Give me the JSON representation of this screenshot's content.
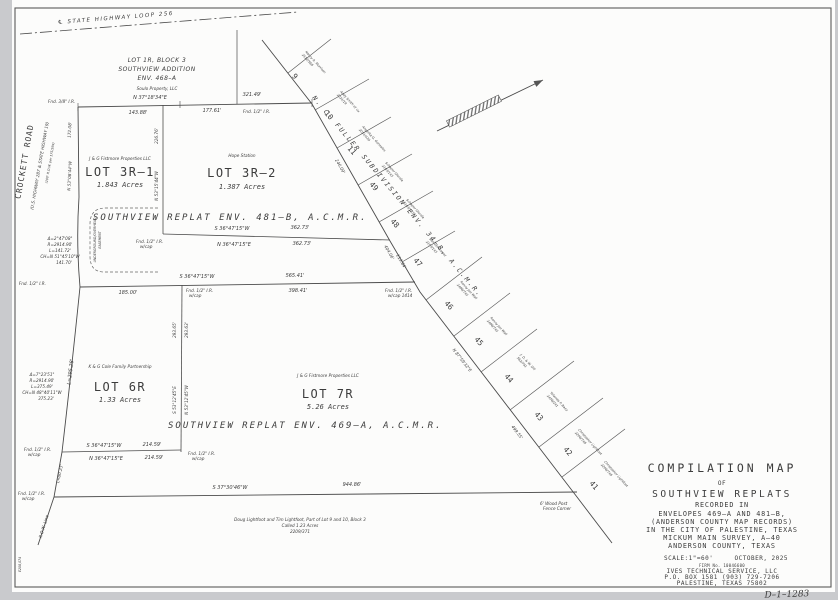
{
  "page": {
    "sheet_no": "D–1–1283",
    "margin_code": "E208,074"
  },
  "highway": {
    "label": "℄  STATE  HIGHWAY  LOOP  256"
  },
  "crockett": {
    "name": "CROCKETT  ROAD",
    "hw": "(U.S. HIGHWAY 287 & STATE HIGHWAY 19)",
    "row": "(100' R.O.W. per 175/594)"
  },
  "lot1r": {
    "line1": "LOT 1R, BLOCK 3",
    "line2": "SOUTHVIEW ADDITION",
    "line3": "ENV. 468–A",
    "owner": "Soulo Property, LLC"
  },
  "lot3r1": {
    "owner": "J & G Fistmore Properties LLC",
    "name": "LOT 3R–1",
    "acres": "1.843 Acres"
  },
  "lot3r2": {
    "owner": "Hope Station",
    "name": "LOT 3R–2",
    "acres": "1.387 Acres"
  },
  "lot6r": {
    "owner": "K & G Cole Family Partnership",
    "name": "LOT 6R",
    "acres": "1.33 Acres"
  },
  "lot7r": {
    "owner": "J & G Fistmore Properties LLC",
    "name": "LOT 7R",
    "acres": "5.26 Acres"
  },
  "replat": {
    "env481": "SOUTHVIEW  REPLAT   ENV.  481–B,  A.C.M.R.",
    "env469": "SOUTHVIEW  REPLAT   ENV.  469–A,  A.C.M.R."
  },
  "fuller": {
    "title": "N. C.  FULLER  SUBDIVISION     ENV.  34–B,  A.C.M.R.",
    "lots": [
      {
        "num": "9",
        "owner": "Nancy A. Morrison",
        "deed": "2512/568"
      },
      {
        "num": "10",
        "owner": "Andy Smith et ux",
        "deed": "2021/19"
      },
      {
        "num": "11",
        "owner": "Angelita G. Gonzales",
        "deed": "2051/439"
      },
      {
        "num": "49",
        "owner": "Schaper Glenda",
        "deed": "2103/143"
      },
      {
        "num": "48",
        "owner": "Schaper Glenda",
        "deed": "2103/143"
      },
      {
        "num": "47",
        "owner": "Samuel Gomez",
        "deed": "2103/143"
      },
      {
        "num": "46",
        "owner": "Ronny Joe Wall",
        "deed": "2486/742"
      },
      {
        "num": "45",
        "owner": "Ronny Joe Wall",
        "deed": "2486/742"
      },
      {
        "num": "44",
        "owner": "J. D. & W. Dill",
        "deed": "562/791"
      },
      {
        "num": "43",
        "owner": "Yolanda P. Baez",
        "deed": "2456/241"
      },
      {
        "num": "42",
        "owner": "Christopher Lightfoot",
        "deed": "2206/748"
      },
      {
        "num": "41",
        "owner": "Christopher Lightfoot",
        "deed": "2206/748"
      }
    ]
  },
  "dims": {
    "top_bearing": "N 37°18'34\"E",
    "top_total": "321.49'",
    "top_d1": "143.88'",
    "top_d2": "177.61'",
    "west_dist": "172.08'",
    "west_bearing": "N 53°08'44\"W",
    "div1_dist": "226.76'",
    "div1_bearing": "N 53°15'44\"W",
    "l362_s": "S 36°47'15\"W",
    "l362_n": "N 36°47'15\"E",
    "d362": "362.73'",
    "mid_bearing": "S 36°47'15\"W",
    "mid_d1": "185.00'",
    "mid_total": "565.41'",
    "mid_sub": "398.41'",
    "div2_dl": "293.65'",
    "div2_dr": "293.63'",
    "div2_s": "S 53°12'45\"E",
    "div2_n": "N 53°12'45\"W",
    "b6r_s": "S 36°47'15\"W",
    "b6r_n": "N 36°47'15\"E",
    "b6r_d": "214.59'",
    "bottom_bearing": "S 37°30'46\"W",
    "bottom_dist": "944.86'",
    "arc1": "L=295.28'",
    "arc2": "L=80.23'",
    "row_line": "R.O.W. Line",
    "diag_246": "246.09'",
    "diag_404": "404.06'",
    "diag_113": "113.84'",
    "diag_bearing": "N 87°59'32\"E",
    "diag_499": "499.55'"
  },
  "curve1": {
    "d": "Δ=2°47'08\"",
    "r": "R=2914.90'",
    "l": "L=141.72'",
    "ch": "CH=N 51°45'10\"W",
    "chd": "141.70'"
  },
  "curve2": {
    "d": "Δ=7°23'51\"",
    "r": "R=2914.90'",
    "l": "L=375.49'",
    "ch": "CH=N 48°40'11\"W",
    "chd": "375.23'"
  },
  "monuments": {
    "fnd38": "Fnd. 3/8\" I.R.",
    "fnd12": "Fnd. 1/2\" I.R.",
    "wcap": "w/cap",
    "wcap1414": "w/cap 1414",
    "fence1": "6' Wood Post",
    "fence2": "Fence Corner"
  },
  "easement": {
    "line1": "UNDERGROUND/OVERHEAD",
    "line2": "EASEMENT"
  },
  "note": {
    "line1": "Doug Lightfoot and Tim Lightfoot,  Part of Lot 9 and 10, Block 3",
    "line2": "Called 1.23 Acres",
    "line3": "2209/371"
  },
  "title_block": {
    "l1": "COMPILATION  MAP",
    "l2": "OF",
    "l3": "SOUTHVIEW  REPLATS",
    "l4": "RECORDED  IN",
    "l5": "ENVELOPES  469–A  AND  481–B,",
    "l6": "(ANDERSON  COUNTY  MAP  RECORDS)",
    "l7": "IN  THE  CITY  OF  PALESTINE,  TEXAS",
    "l8": "MICKUM  MAIN  SURVEY,  A–40",
    "l9": "ANDERSON  COUNTY,  TEXAS",
    "scale": "SCALE:1\"=60'",
    "date": "OCTOBER,  2025",
    "firm": "FIRM No. 10046600",
    "company": "IVES  TECHNICAL  SERVICE,  LLC",
    "address": "P.O. BOX 1581   (903) 729-7206",
    "city": "PALESTINE,  TEXAS  75802"
  }
}
